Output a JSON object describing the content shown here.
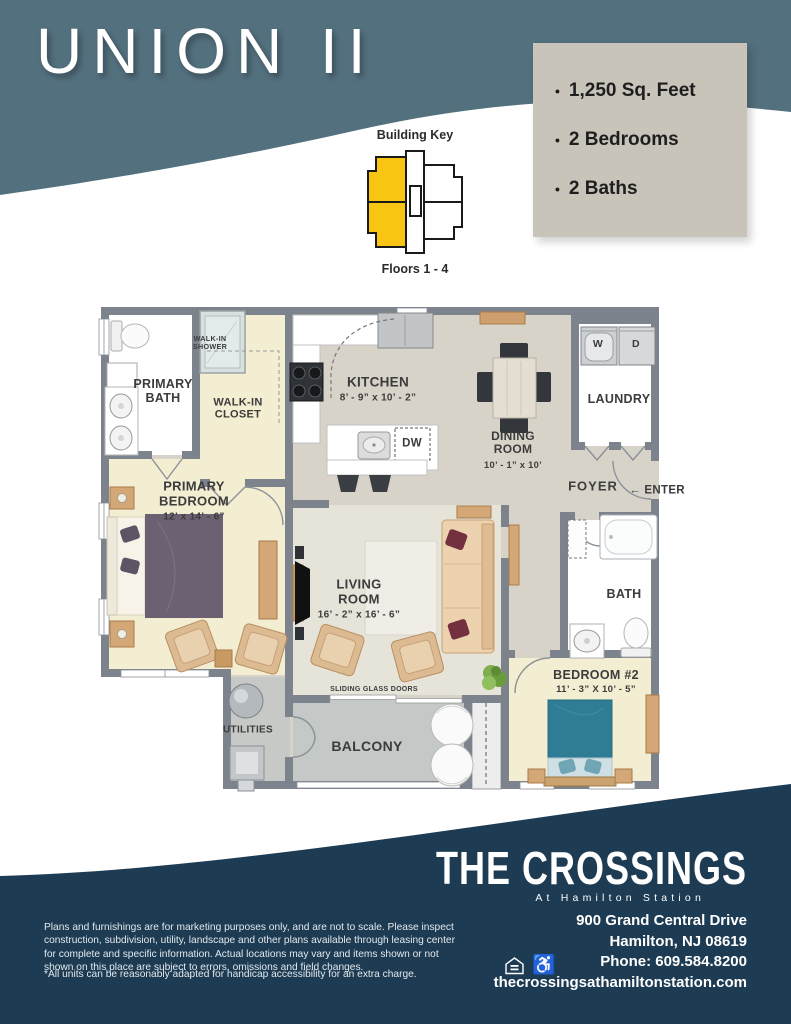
{
  "header": {
    "title": "UNION II"
  },
  "building_key": {
    "title": "Building Key",
    "floors": "Floors 1 - 4",
    "highlight_color": "#f9c513"
  },
  "info_box": {
    "bullet": "•",
    "items": [
      "1,250 Sq. Feet",
      "2 Bedrooms",
      "2 Baths"
    ]
  },
  "plan": {
    "primary_bath": "PRIMARY BATH",
    "walk_in_shower": "WALK-IN SHOWER",
    "walk_in_closet": "WALK-IN CLOSET",
    "kitchen": "KITCHEN",
    "kitchen_dims": "8’ - 9” x 10’ - 2”",
    "dining_room": "DINING ROOM",
    "dining_dims": "10’ - 1” x 10’",
    "laundry": "LAUNDRY",
    "washer": "W",
    "dryer": "D",
    "dishwasher": "DW",
    "foyer": "FOYER",
    "enter_arrow": "←",
    "enter": "ENTER",
    "primary_bedroom": "PRIMARY BEDROOM",
    "primary_bedroom_dims": "12’ x 14’ - 6”",
    "living_room": "LIVING ROOM",
    "living_room_dims": "16’ - 2” x 16’ - 6”",
    "sliding_glass_doors": "SLIDING GLASS DOORS",
    "bath": "BATH",
    "bedroom2": "BEDROOM #2",
    "bedroom2_dims": "11’ - 3” X 10’ - 5”",
    "utilities": "UTILITIES",
    "balcony": "BALCONY"
  },
  "footer": {
    "logo_name": "THE CROSSINGS",
    "logo_subtitle": "At Hamilton Station",
    "address_lines": [
      "900 Grand Central Drive",
      "Hamilton, NJ 08619",
      "Phone: 609.584.8200",
      "thecrossingsathamiltonstation.com"
    ],
    "disclaimer": "Plans and furnishings are for marketing purposes only, and are not to scale. Please inspect construction, subdivision, utility, landscape and other plans available through leasing center for complete and specific information. Actual locations may vary and items shown or not shown on this place are subject to errors, omissions and field changes.",
    "footnote": "*All units can be reasonably adapted for handicap accessibility for an extra charge.",
    "accessibility_icon": "♿"
  },
  "colors": {
    "slate_header": "#53707e",
    "navy_footer": "#1d3b53",
    "info_box_bg": "#c8c4ba",
    "key_yellow": "#f9c513",
    "wall_gray": "#7d838c",
    "open_floor": "#d8d3c8",
    "bedroom_cream": "#f3edd2",
    "balcony_gray": "#c6c9c6"
  }
}
